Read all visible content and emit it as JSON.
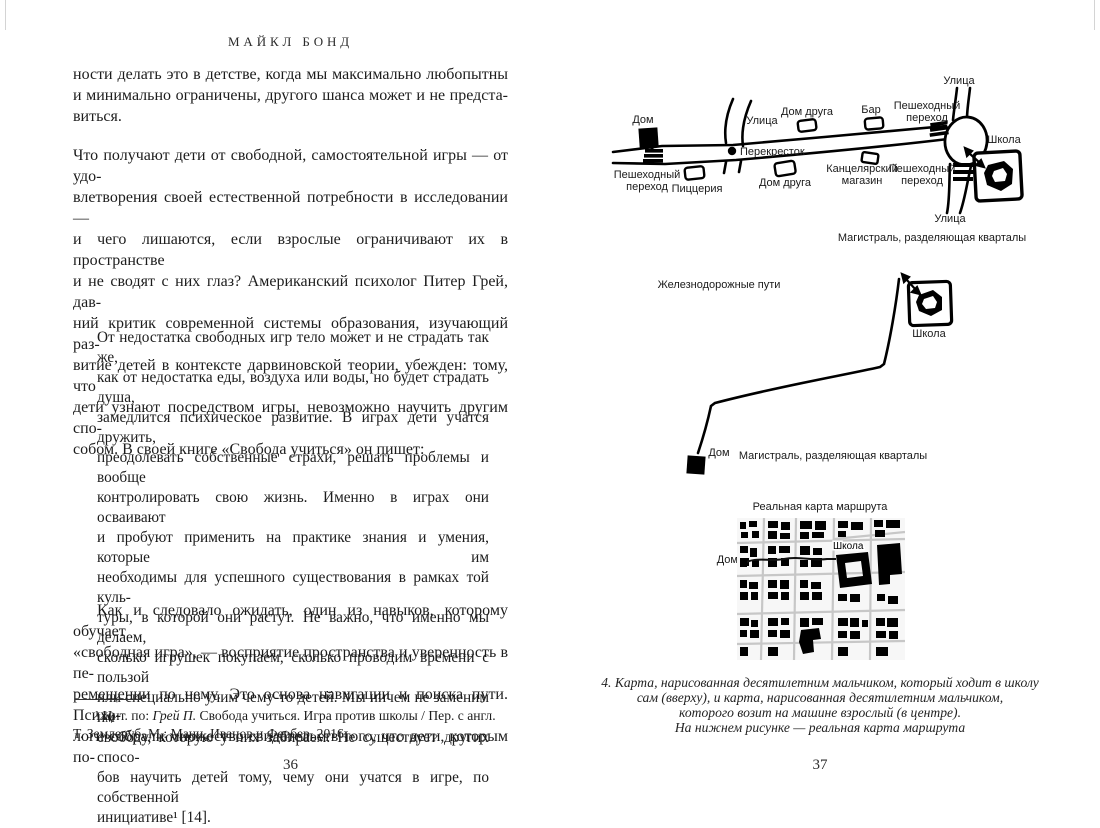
{
  "book": {
    "running_header": "МАЙКЛ БОНД",
    "left_page": {
      "page_number": "36",
      "paragraph_1_lines": [
        "ности делать это в детстве, когда мы максимально любопытны",
        "и минимально ограничены, другого шанса может и не предста-",
        "виться."
      ],
      "paragraph_2_lines": [
        "Что получают дети от свободной, самостоятельной игры — от удо-",
        "влетворения своей естественной потребности в исследовании —",
        "и чего лишаются, если взрослые ограничивают их в пространстве",
        "и не сводят с них глаз? Американский психолог Питер Грей, дав-",
        "ний критик современной системы образования, изучающий раз-",
        "витие детей в контексте дарвиновской теории, убежден: тому, что",
        "дети узнают посредством игры, невозможно научить другим спо-",
        "собом. В своей книге «Свобода учиться» он пишет:"
      ],
      "quote_lines": [
        "От недостатка свободных игр тело может и не страдать так же,",
        "как от недостатка еды, воздуха или воды, но будет страдать душа,",
        "замедлится психическое развитие. В играх дети учатся дружить,",
        "преодолевать собственные страхи, решать проблемы и вообще",
        "контролировать свою жизнь. Именно в играх они осваивают",
        "и пробуют применить на практике знания и умения, которые им",
        "необходимы для успешного существования в рамках той куль-",
        "туры, в которой они растут. Не важно, что именно мы делаем,",
        "сколько игрушек покупаем, сколько проводим времени с пользой",
        "или специально учим чему-то детей. Мы ничем не заменим им",
        "свободу, которую у них забираем. Не существует других спосо-",
        "бов научить детей тому, чему они учатся в игре, по собственной",
        "инициативе¹ [14]."
      ],
      "paragraph_3_lines": [
        "Как и следовало ожидать, один из навыков, которому обучает",
        "«свободная игра», — восприятие пространства и уверенность в пе-",
        "ремещении по нему. Это основа навигации и поиска пути. Психо-",
        "логи собрали множество свидетельств того, что дети, которым по-"
      ],
      "footnote": {
        "line1_prefix": "¹ Цит. по: ",
        "line1_italic": "Грей П.",
        "line1_rest": " Свобода учиться. Игра против школы / Пер. с англ.",
        "line2": "Т. Землеруб. М.: Манн, Иванов и Фербер, 2016."
      }
    },
    "right_page": {
      "page_number": "37",
      "map_walking": {
        "home": "Дом",
        "street_top": "Улица",
        "street_mid": "Улица",
        "street_bottom": "Улица",
        "friend_house_top": "Дом друга",
        "friend_house_bottom": "Дом друга",
        "bar": "Бар",
        "crossing_line1": "Пешеходный",
        "crossing_line2": "переход",
        "school": "Школа",
        "intersection": "Перекресток",
        "pizzeria": "Пиццерия",
        "stationery_line1": "Канцелярский",
        "stationery_line2": "магазин",
        "highway": "Магистраль, разделяющая кварталы"
      },
      "map_driven": {
        "railways": "Железнодорожные пути",
        "school": "Школа",
        "home": "Дом",
        "highway": "Магистраль, разделяющая кварталы"
      },
      "map_real": {
        "title": "Реальная карта маршрута",
        "home": "Дом",
        "school": "Школа"
      },
      "caption_lines": [
        "4. Карта, нарисованная десятилетним мальчиком, который ходит в школу",
        "сам (вверху), и карта, нарисованная десятилетним мальчиком,",
        "которого возит на машине взрослый (в центре).",
        "На нижнем рисунке — реальная карта маршрута"
      ]
    }
  }
}
